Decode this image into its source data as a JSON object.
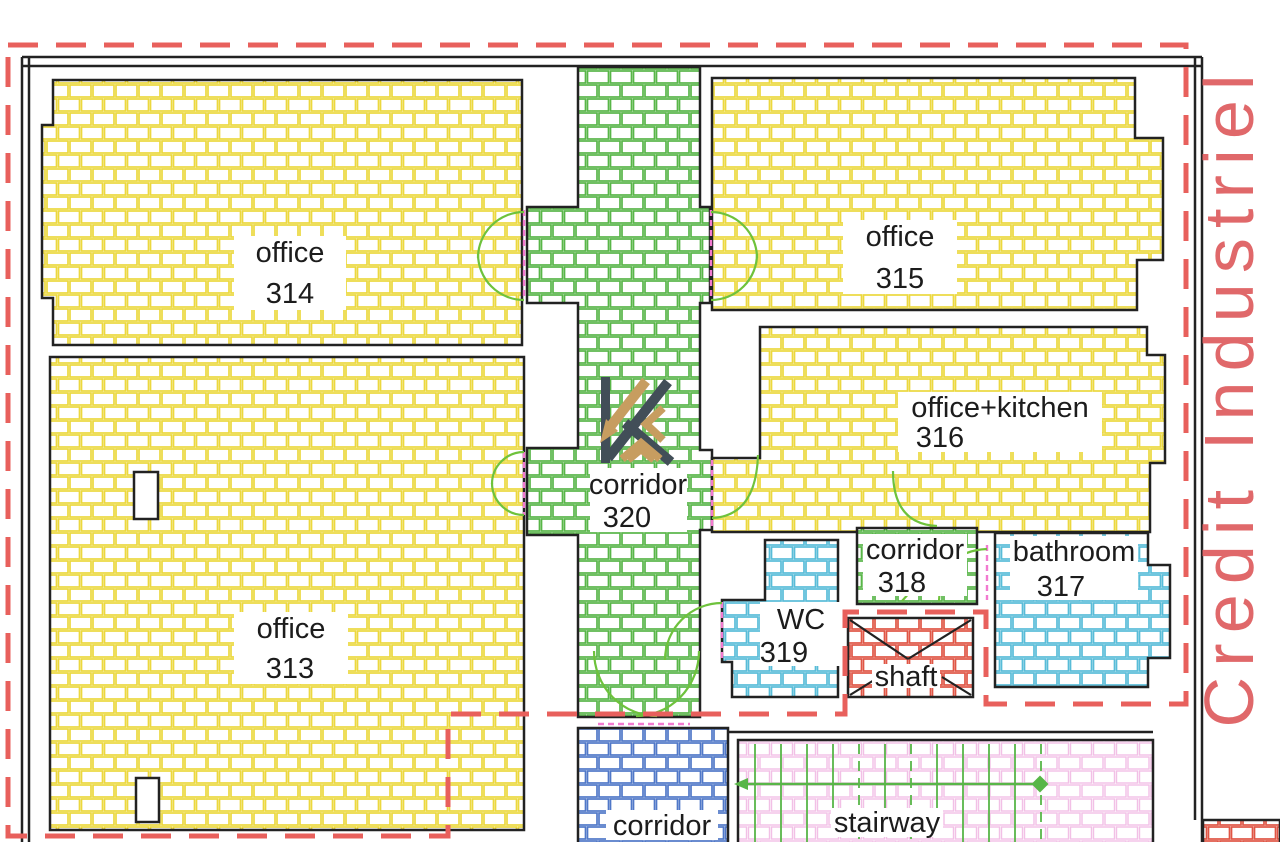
{
  "side_text": "Credit Industriel",
  "rooms": {
    "office_314": {
      "label": "office",
      "number": "314"
    },
    "office_315": {
      "label": "office",
      "number": "315"
    },
    "office_313": {
      "label": "office",
      "number": "313"
    },
    "office_kitchen_316": {
      "label": "office+kitchen",
      "number": "316"
    },
    "corridor_320": {
      "label": "corridor",
      "number": "320"
    },
    "corridor_318": {
      "label": "corridor",
      "number": "318"
    },
    "bathroom_317": {
      "label": "bathroom",
      "number": "317"
    },
    "wc_319": {
      "label": "WC",
      "number": "319"
    },
    "shaft": {
      "label": "shaft"
    },
    "corridor_bottom": {
      "label": "corridor"
    },
    "stairway": {
      "label": "stairway"
    }
  },
  "colors": {
    "office_hatch": "#ecd83e",
    "corridor_hatch": "#58b648",
    "bathroom_wc_hatch": "#58bcd8",
    "bottom_corridor_hatch": "#5078c8",
    "shaft_hatch": "#e05545",
    "stairway_hatch": "#f0bce0",
    "lease_boundary_dash": "#e8605c",
    "side_text_color": "#e0686a",
    "door_threshold_pink": "#f27ad0",
    "door_arc_green": "#6ec23c",
    "wall_black": "#222222",
    "logo_slate": "#424e58",
    "logo_tan": "#c79d60"
  }
}
